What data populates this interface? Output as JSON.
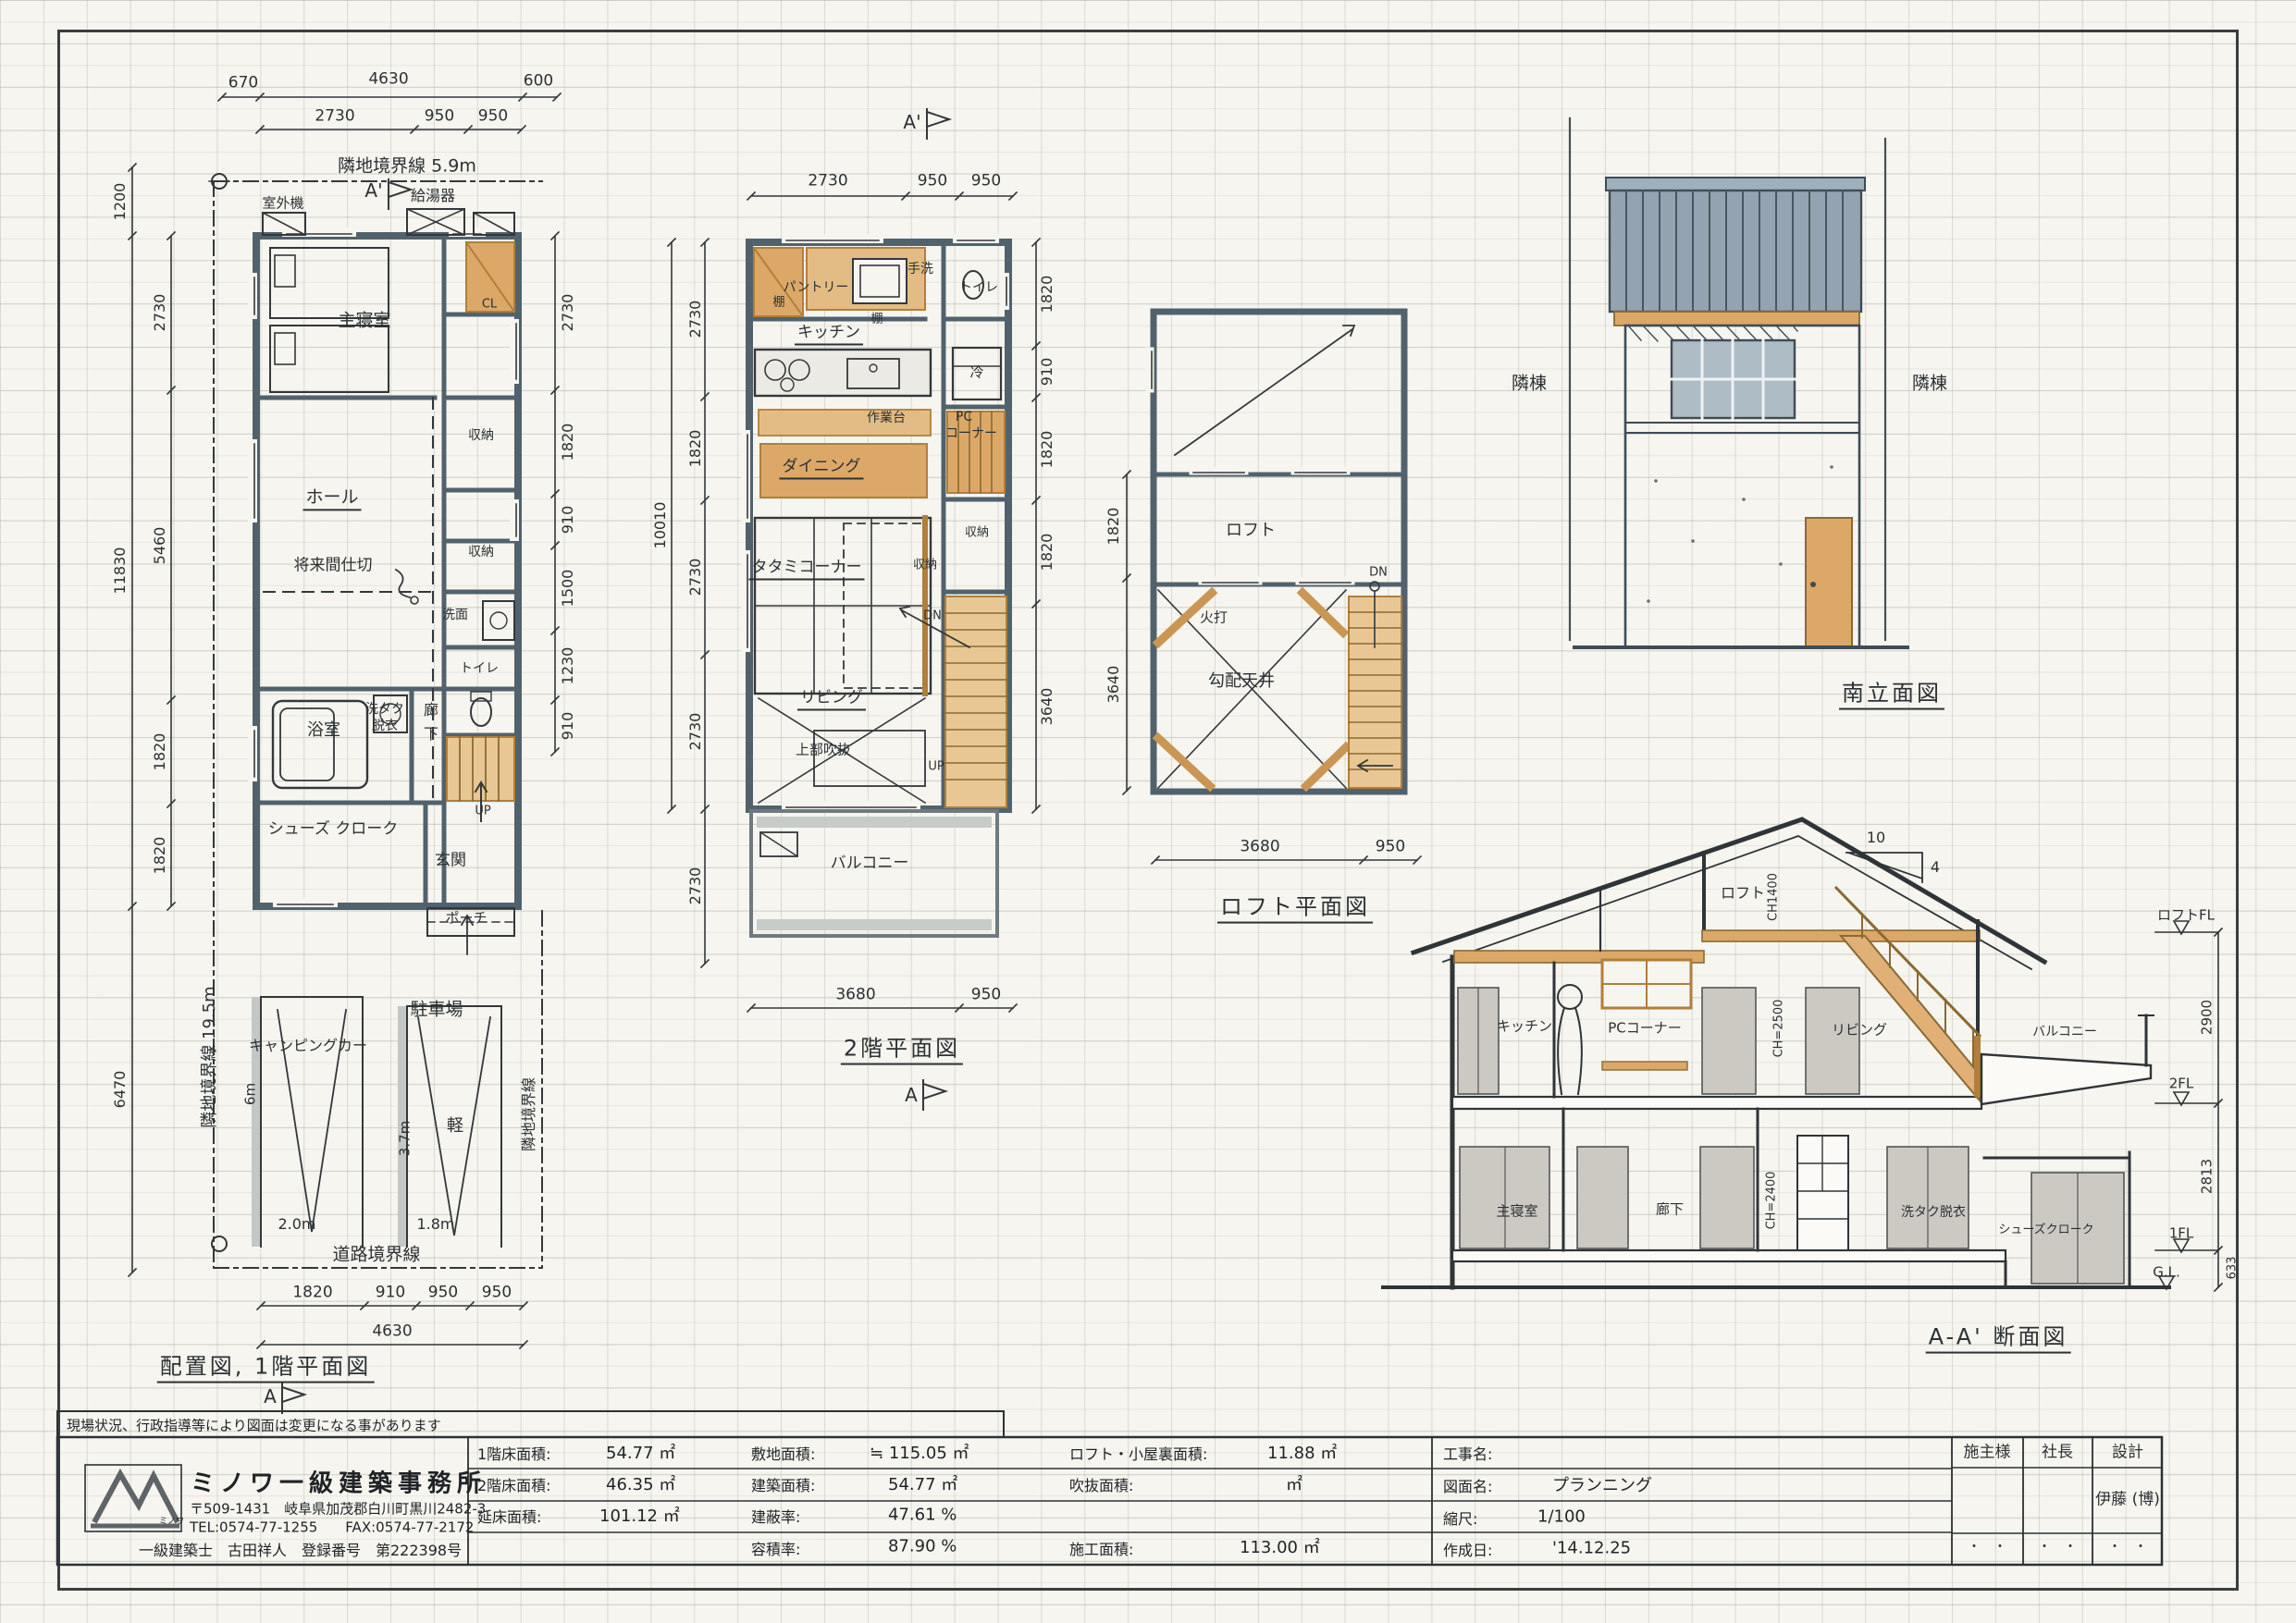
{
  "sheet": {
    "note": "現場状況、行政指導等により図面は変更になる事があります"
  },
  "plan1f": {
    "title": "配置図, 1階平面図",
    "marker_top": "A'",
    "marker_bottom": "A",
    "dims_row1": [
      "670",
      "4630",
      "600"
    ],
    "dims_row2": [
      "2730",
      "950",
      "950"
    ],
    "boundary_top": "隣地境界線 5.9m",
    "boundary_left": "隣地境界線 19.5m",
    "boundary_right": "隣地境界線",
    "boundary_road": "道路境界線",
    "water_heater": "給湯器",
    "outdoor_unit": "室外機",
    "room_master": "主寝室",
    "room_cl": "CL",
    "room_hall": "ホール",
    "room_future": "将来間仕切",
    "room_storage1": "収納",
    "room_storage2": "収納",
    "room_washroom": "洗面",
    "room_toilet": "トイレ",
    "room_bath": "浴室",
    "room_laundry1": "洗タク",
    "room_laundry2": "脱衣",
    "room_corridor1": "廊",
    "room_corridor2": "下",
    "room_up": "UP",
    "room_shoes": "シューズ クローク",
    "room_entry": "玄関",
    "room_porch": "ポーチ",
    "site_camper": "キャンピングカー",
    "site_6m": "6m",
    "site_2m": "2.0m",
    "site_parking": "駐車場",
    "site_kei": "軽",
    "site_37m": "3.7m",
    "site_18m": "1.8m",
    "dims_left": [
      "1200",
      "2730",
      "5460",
      "11830",
      "1820",
      "1820",
      "6470"
    ],
    "dims_right": [
      "2730",
      "1820",
      "910",
      "1500",
      "1230",
      "910"
    ],
    "dims_bottom1": [
      "1820",
      "910",
      "950",
      "950"
    ],
    "dims_bottom2": "4630"
  },
  "plan2f": {
    "title": "2階平面図",
    "marker_top": "A'",
    "marker_bottom": "A",
    "dims_top": [
      "2730",
      "950",
      "950"
    ],
    "room_pantry": "パントリー",
    "room_shelf1": "棚",
    "room_shelf2": "棚",
    "room_handwash": "手洗",
    "room_toilet": "トイレ",
    "room_kitchen": "キッチン",
    "room_fridge": "冷",
    "room_worktop": "作業台",
    "room_pc1": "PC",
    "room_pc2": "コーナー",
    "room_dining": "ダイニング",
    "room_tatami": "タタミコーナー",
    "room_storage1": "収納",
    "room_storage2": "収納",
    "room_dn": "DN",
    "room_living": "リビング",
    "room_void": "上部吹抜",
    "room_up": "UP",
    "room_balcony": "バルコニー",
    "dims_left": [
      "2730",
      "1820",
      "2730",
      "2730"
    ],
    "dim_left_total": "10010",
    "dim_balcony": "2730",
    "dims_right": [
      "1820",
      "910",
      "1820",
      "1820",
      "3640"
    ],
    "dims_bottom": [
      "3680",
      "950"
    ]
  },
  "loft": {
    "title": "ロフト平面図",
    "room_loft": "ロフト",
    "room_dn": "DN",
    "room_hiuchi": "火打",
    "room_ceiling": "勾配天井",
    "dims_left": [
      "1820",
      "3640"
    ],
    "dims_bottom": [
      "3680",
      "950"
    ]
  },
  "elevation": {
    "title": "南立面図",
    "neighbor_left": "隣棟",
    "neighbor_right": "隣棟"
  },
  "section": {
    "title": "A-A' 断面図",
    "slope_run": "10",
    "slope_rise": "4",
    "loft": "ロフト",
    "ch_loft": "CH1400",
    "kitchen": "キッチン",
    "pc": "PCコーナー",
    "ch_2f": "CH=2500",
    "living": "リビング",
    "balcony": "バルコニー",
    "master": "主寝室",
    "corridor": "廊下",
    "ch_1f": "CH=2400",
    "laundry": "洗タク脱衣",
    "shoes": "シューズクローク",
    "lv_loft": "ロフトFL",
    "lv_2f": "2FL",
    "lv_1f": "1FL",
    "lv_gl": "G.L.",
    "dim_2900": "2900",
    "dim_2813": "2813",
    "dim_633": "633"
  },
  "titleblock": {
    "company": "ミノワ一級建築事務所",
    "address": "〒509-1431　岐阜県加茂郡白川町黒川2482-3",
    "tel": "TEL:0574-77-1255　　FAX:0574-77-2172",
    "architect": "一級建築士　古田祥人　登録番号　第222398号",
    "logo_caption": "ミノワ",
    "areas1": [
      {
        "label": "1階床面積:",
        "value": "54.77 ㎡"
      },
      {
        "label": "2階床面積:",
        "value": "46.35 ㎡"
      },
      {
        "label": "延床面積:",
        "value": "101.12 ㎡"
      }
    ],
    "areas2": [
      {
        "label": "敷地面積:",
        "value": "≒ 115.05 ㎡"
      },
      {
        "label": "建築面積:",
        "value": "54.77 ㎡"
      },
      {
        "label": "建蔽率:",
        "value": "47.61 %"
      },
      {
        "label": "容積率:",
        "value": "87.90 %"
      }
    ],
    "areas3": [
      {
        "label": "ロフト・小屋裏面積:",
        "value": "11.88 ㎡"
      },
      {
        "label": "吹抜面積:",
        "value": "㎡"
      },
      {
        "label": "施工面積:",
        "value": "113.00 ㎡"
      }
    ],
    "info": [
      {
        "label": "工事名:",
        "value": ""
      },
      {
        "label": "図面名:",
        "value": "プランニング"
      },
      {
        "label": "縮尺:",
        "value": "1/100"
      },
      {
        "label": "作成日:",
        "value": "'14.12.25"
      }
    ],
    "sign_headers": [
      "施主様",
      "社長",
      "設計"
    ],
    "designer": "伊藤 (博)",
    "dots": "・　・"
  }
}
